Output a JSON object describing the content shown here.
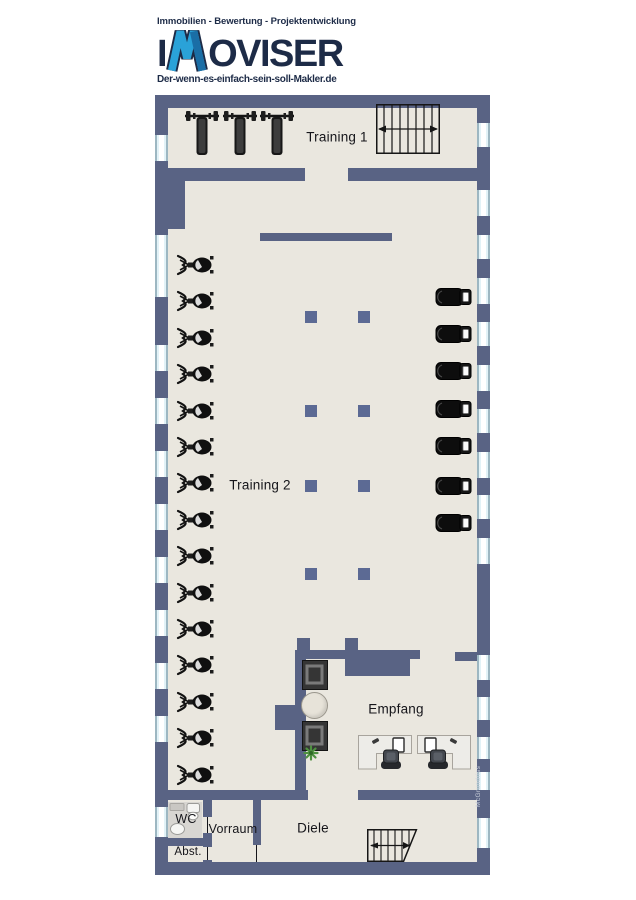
{
  "letterhead": {
    "tagline_top": "Immobilien - Bewertung - Projektentwicklung",
    "brand_prefix": "I",
    "brand_suffix": "OVISER",
    "brand_full": "IMOVISER",
    "tagline_bottom": "Der-wenn-es-einfach-sein-soll-Makler.de"
  },
  "floor_plan": {
    "rooms": {
      "training1": "Training 1",
      "training2": "Training 2",
      "empfang": "Empfang",
      "diele": "Diele",
      "vorraum": "Vorraum",
      "wc": "WC",
      "abst": "Abst."
    },
    "watermark": "McGrundriss",
    "equipment": {
      "bench_count": 3,
      "left_machine_count": 15,
      "treadmill_count": 7,
      "pillar_count": 8,
      "armchair_count": 2,
      "desk_count": 2,
      "staircase_count": 2
    },
    "colors": {
      "wall": "#596384",
      "floor": "#eae7df",
      "window_glass": "#e2f2f7",
      "window_frame": "#9db7c2",
      "pillar": "#5c6a94",
      "navy": "#1d2b47",
      "logo_blue": "#2aa2d8",
      "logo_blue_dark": "#1a6ea6",
      "equipment_dark": "#141414",
      "plant_green": "#4e9140"
    }
  }
}
